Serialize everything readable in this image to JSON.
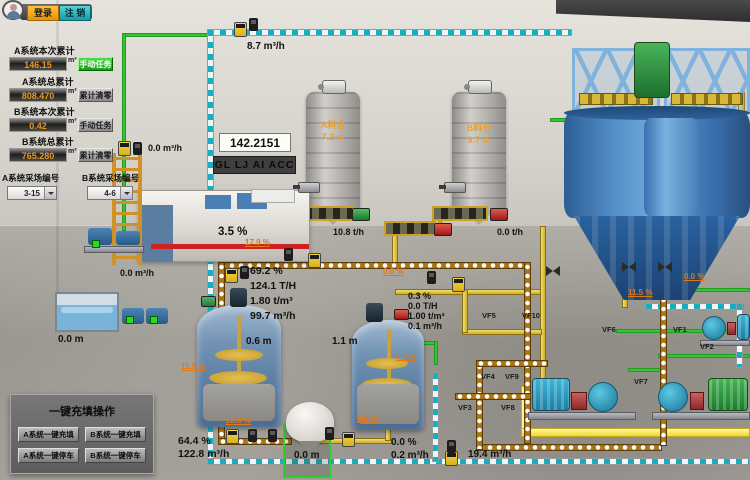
{
  "header": {
    "login": "登录",
    "logout": "注 销"
  },
  "panel": {
    "rows": [
      {
        "label": "A系统本次累计",
        "value": "146.15",
        "unit": "m³",
        "btn": "手动任务"
      },
      {
        "label": "A系统总累计",
        "value": "808.470",
        "unit": "m³",
        "btn": "累计清零"
      },
      {
        "label": "B系统本次累计",
        "value": "0.42",
        "unit": "m³",
        "btn": "手动任务"
      },
      {
        "label": "B系统总累计",
        "value": "765.280",
        "unit": "m³",
        "btn": "累计清零"
      }
    ],
    "site_a_label": "A系统采场编号",
    "site_a_value": "3-15",
    "site_b_label": "B系统采场编号",
    "site_b_value": "4-6"
  },
  "onekey": {
    "title": "一键充填操作",
    "buttons": [
      "A系统一键充填",
      "B系统一键充填",
      "A系统一键停车",
      "B系统一键停车"
    ]
  },
  "display": {
    "value": "142.2151",
    "marquee": "GL LJ AI ACC"
  },
  "silos": {
    "a_name": "A料仓",
    "a_level": "7.2  m",
    "b_name": "B料仓",
    "b_level": "9.7  m"
  },
  "conveyors": {
    "a_rate": "10.8  t/h",
    "b_rate": "0.0  t/h"
  },
  "readings": {
    "top_flow": "8.7  m³/h",
    "left_top_flow": "0.0 m³/h",
    "left_bottom_flow": "0.0  m³/h",
    "fine_tank_level": "3.5  %",
    "water_level": "0.0  m",
    "tank1_level": "0.6  m",
    "tank2_level": "1.1  m",
    "hopper_level": "0.0  m",
    "drain_flow": "19.4  m³/h",
    "group_a": [
      "69.2   %",
      "124.1  T/H",
      "1.80  t/m³",
      "99.7  m³/h"
    ],
    "group_b": [
      "0.3    %",
      "0.0   T/H",
      "1.00  t/m³",
      "0.1   m³/h"
    ],
    "group_bottom_left": [
      "64.4    %",
      "122.8 m³/h"
    ],
    "group_bottom_mid": [
      "0.0    %",
      "0.2   m³/h"
    ]
  },
  "valve_pcts": {
    "line_a": "17.9 %",
    "left": "11.9 %",
    "tank1_out": "28.8 %",
    "line_b": "0.0 %",
    "tank2_out": "0.0 %",
    "hopper_line": "0.0 %",
    "right_top": "0.0 %",
    "right_mid": "11.5 %"
  },
  "valve_tags": {
    "vf1": "VF1",
    "vf2": "VF2",
    "vf3": "VF3",
    "vf4": "VF4",
    "vf5": "VF5",
    "vf6": "VF6",
    "vf7": "VF7",
    "vf8": "VF8",
    "vf9": "VF9",
    "vf10": "VF10"
  },
  "colors": {
    "green_pipe": "#35c435",
    "yellow_pipe": "#e8cf4c",
    "cyan_pipe": "#22b0c4",
    "slurry_pipe": "#a87414",
    "valve_open": "#28c828",
    "valve_closed": "#e02020",
    "accent_orange": "#f0a818",
    "accent_teal": "#30b8c0"
  }
}
